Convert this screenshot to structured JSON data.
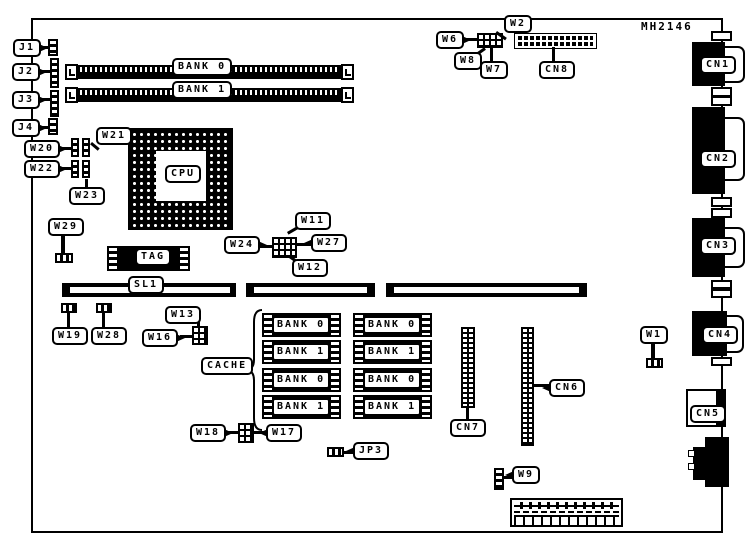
{
  "board": {
    "model": "MH2146"
  },
  "labels": {
    "j1": "J1",
    "j2": "J2",
    "j3": "J3",
    "j4": "J4",
    "w1": "W1",
    "w2": "W2",
    "w6": "W6",
    "w7": "W7",
    "w8": "W8",
    "w9": "W9",
    "w11": "W11",
    "w12": "W12",
    "w13": "W13",
    "w16": "W16",
    "w17": "W17",
    "w18": "W18",
    "w19": "W19",
    "w20": "W20",
    "w21": "W21",
    "w22": "W22",
    "w23": "W23",
    "w24": "W24",
    "w27": "W27",
    "w28": "W28",
    "w29": "W29",
    "cn1": "CN1",
    "cn2": "CN2",
    "cn3": "CN3",
    "cn4": "CN4",
    "cn5": "CN5",
    "cn6": "CN6",
    "cn7": "CN7",
    "cn8": "CN8",
    "jp3": "JP3",
    "sl1": "SL1",
    "cpu": "CPU",
    "tag": "TAG",
    "cache": "CACHE"
  },
  "memory_slots": [
    {
      "label": "BANK 0"
    },
    {
      "label": "BANK 1"
    }
  ],
  "cache_chips": [
    {
      "label": "BANK 0"
    },
    {
      "label": "BANK 1"
    },
    {
      "label": "BANK 0"
    },
    {
      "label": "BANK 1"
    },
    {
      "label": "BANK 0"
    },
    {
      "label": "BANK 1"
    },
    {
      "label": "BANK 0"
    },
    {
      "label": "BANK 1"
    }
  ]
}
